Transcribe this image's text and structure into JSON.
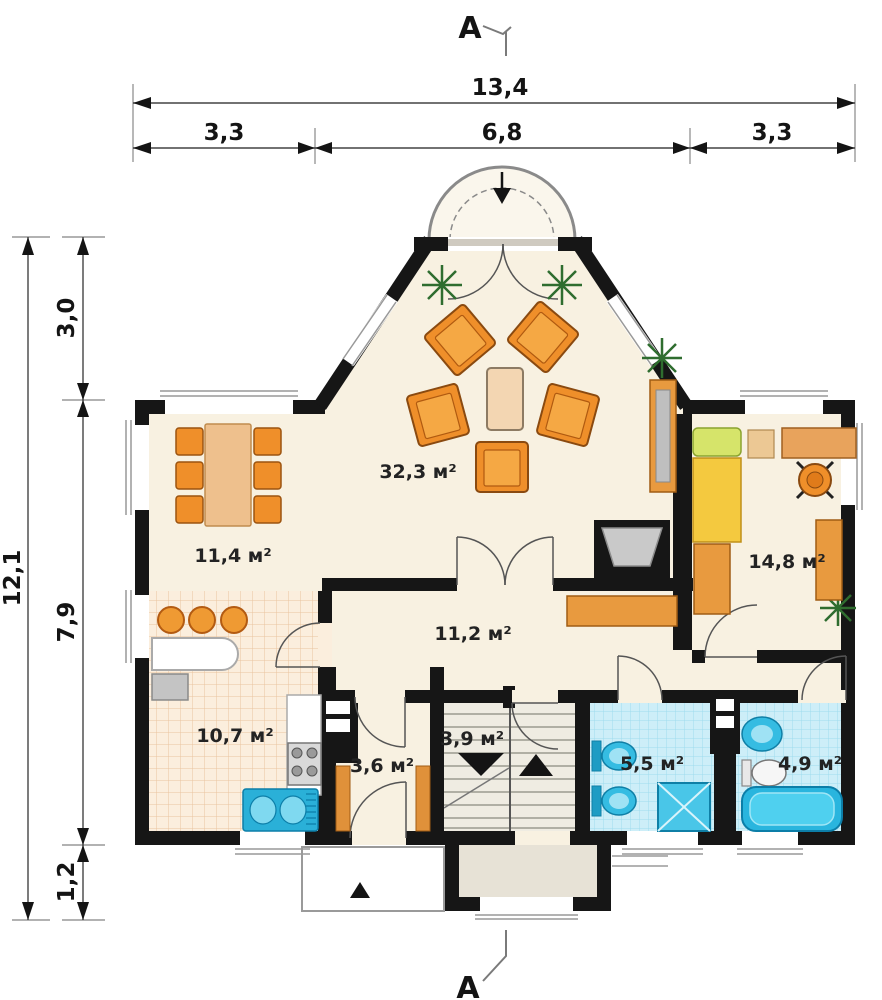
{
  "section_markers": {
    "top": "A",
    "bottom": "A"
  },
  "dimensions": {
    "top": {
      "total": "13,4",
      "segments": [
        "3,3",
        "6,8",
        "3,3"
      ]
    },
    "left": {
      "total": "12,1",
      "segments": [
        "3,0",
        "7,9",
        "1,2"
      ]
    }
  },
  "rooms": {
    "living_room": {
      "area": "32,3 м²"
    },
    "dining_area": {
      "area": "11,4 м²"
    },
    "bedroom": {
      "area": "14,8 м²"
    },
    "hall": {
      "area": "11,2 м²"
    },
    "kitchen": {
      "area": "10,7 м²"
    },
    "mudroom": {
      "area": "3,6 м²"
    },
    "staircase": {
      "area": "3,9 м²"
    },
    "bathroom_small": {
      "area": "5,5 м²"
    },
    "bathroom_large": {
      "area": "4,9 м²"
    }
  },
  "colors": {
    "wall": "#161616",
    "floor_cream": "#f8f1e1",
    "kitchen_tile": "#fbeedd",
    "bath_tile": "#cdeef8",
    "furniture_orange": "#ef8f2a",
    "wood": "#eec08d",
    "bed_yellow": "#f4c93f",
    "pillow_green": "#d6e46a",
    "sanitary_blue": "#35bce2",
    "dimension_line": "#444444"
  }
}
